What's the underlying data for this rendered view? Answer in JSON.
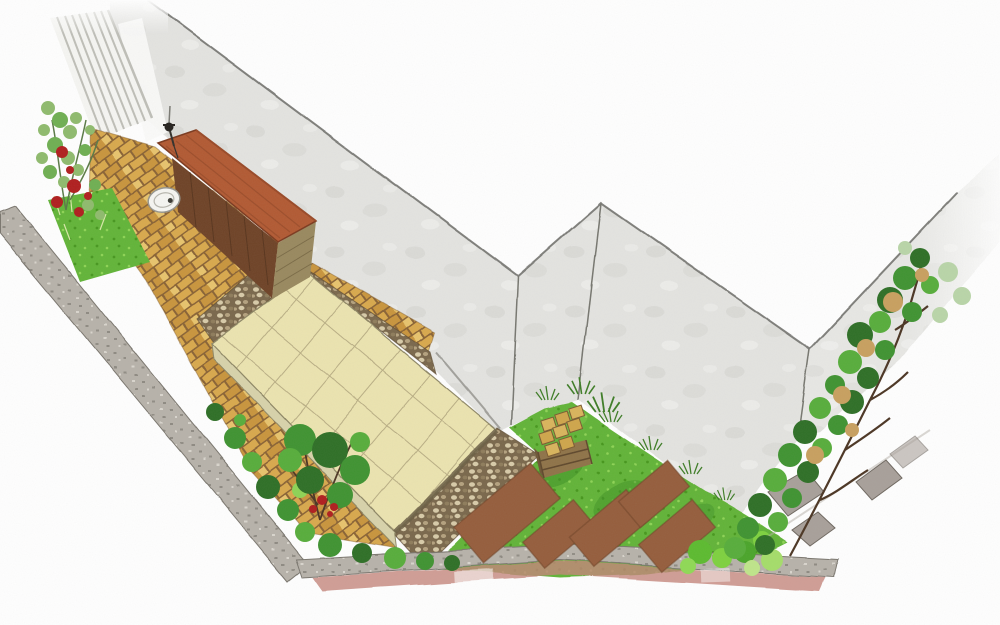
{
  "scene": {
    "title": "Watercolour axonometric garden design illustration of an L-shaped corner plot",
    "style": "hand-drawn sketch on white paper, no text or UI elements",
    "background_color": "#ffffff",
    "colors": {
      "wall": "#e4e4e1",
      "wall_blot": "#d7d7d3",
      "wall_edge": "#6b6b66",
      "fence_white": "#f6f6f3",
      "fence_line": "#bfbfb8",
      "brick": "#d9a94e",
      "brick_alt": "#c9953c",
      "brick_light": "#e8c46d",
      "brick_mortar": "#8a6434",
      "slab": "#ece4b0",
      "slab_joint": "#b9ae84",
      "patio_edge": "#d8d3ab",
      "patio_timber": "#6b5f44",
      "gravel_bg": "#7a684c",
      "pebble_light": "#d8cba9",
      "pebble_mid": "#b5a27f",
      "lawn": "#62b438",
      "lawn_dot_dark": "#47971f",
      "lawn_dot_light": "#8ed455",
      "lawn_patch": "#3e8f26",
      "soil_bed": "#955d3c",
      "soil_edge": "#6e4226",
      "roof": "#b25a33",
      "roof_streak": "#8e4526",
      "shed_front": "#6f4327",
      "shed_side": "#99895f",
      "crate_wood": "#8f7348",
      "block_yellow": "#d9b45c",
      "foliage_dark": "#2e6f26",
      "foliage_mid": "#3f9331",
      "foliage_bright": "#57ad3b",
      "foliage_sage": "#b9d5a8",
      "grass_tuft": "#3e7d26",
      "rose_leaf": "#8fbb6d",
      "rose_red": "#b01e1e",
      "branch_brown": "#4b3523",
      "tan_leaf": "#c8a05f",
      "edging_stone": "#b7b2aa",
      "edging_line": "#7a766e",
      "edging_pink": "#c4847a",
      "stepping_stone": "#a8a09a",
      "manhole": "#f6f6f2",
      "tap_black": "#26231f"
    },
    "elements": {
      "walls": {
        "label": "rendered boundary walls with sketched top edge",
        "faces": 4
      },
      "fence": {
        "label": "white slatted fence, top-left corner",
        "slats": 8
      },
      "brick_path": {
        "label": "yellow clay brick path from fence corner to bottom tip"
      },
      "patio": {
        "label": "raised patio of square cream paving slabs"
      },
      "gravel_margins": {
        "label": "pebble drainage strips bordering the patio",
        "count": 2
      },
      "shed": {
        "label": "timber storage shed with terracotta mono-pitch roof"
      },
      "outdoor_tap": {
        "label": "wall-mounted outdoor tap beside the shed"
      },
      "manhole_cover": {
        "label": "round inspection cover set into the brick path"
      },
      "lawn": {
        "label": "lawn filling the rear corner of the plot"
      },
      "vegetable_beds": {
        "label": "brown rectangular soil planting beds in the lawn",
        "count": 5
      },
      "block_store": {
        "label": "timber crate stacked with yellow walling blocks"
      },
      "climbing_rose": {
        "label": "climbing rose with red blooms against the fence"
      },
      "berry_shrub": {
        "label": "shrub with red berries beside the patio corner"
      },
      "groundcover": {
        "label": "low green planting along the lower-left boundary"
      },
      "tree_screen": {
        "label": "trained trees / espalier screen along right-hand wall"
      },
      "stepping_stones": {
        "label": "grey stepping stones beneath the tree screen",
        "count": 4
      },
      "edging": {
        "label": "grey stone kerb with pink brick strip along the street edges"
      }
    }
  }
}
